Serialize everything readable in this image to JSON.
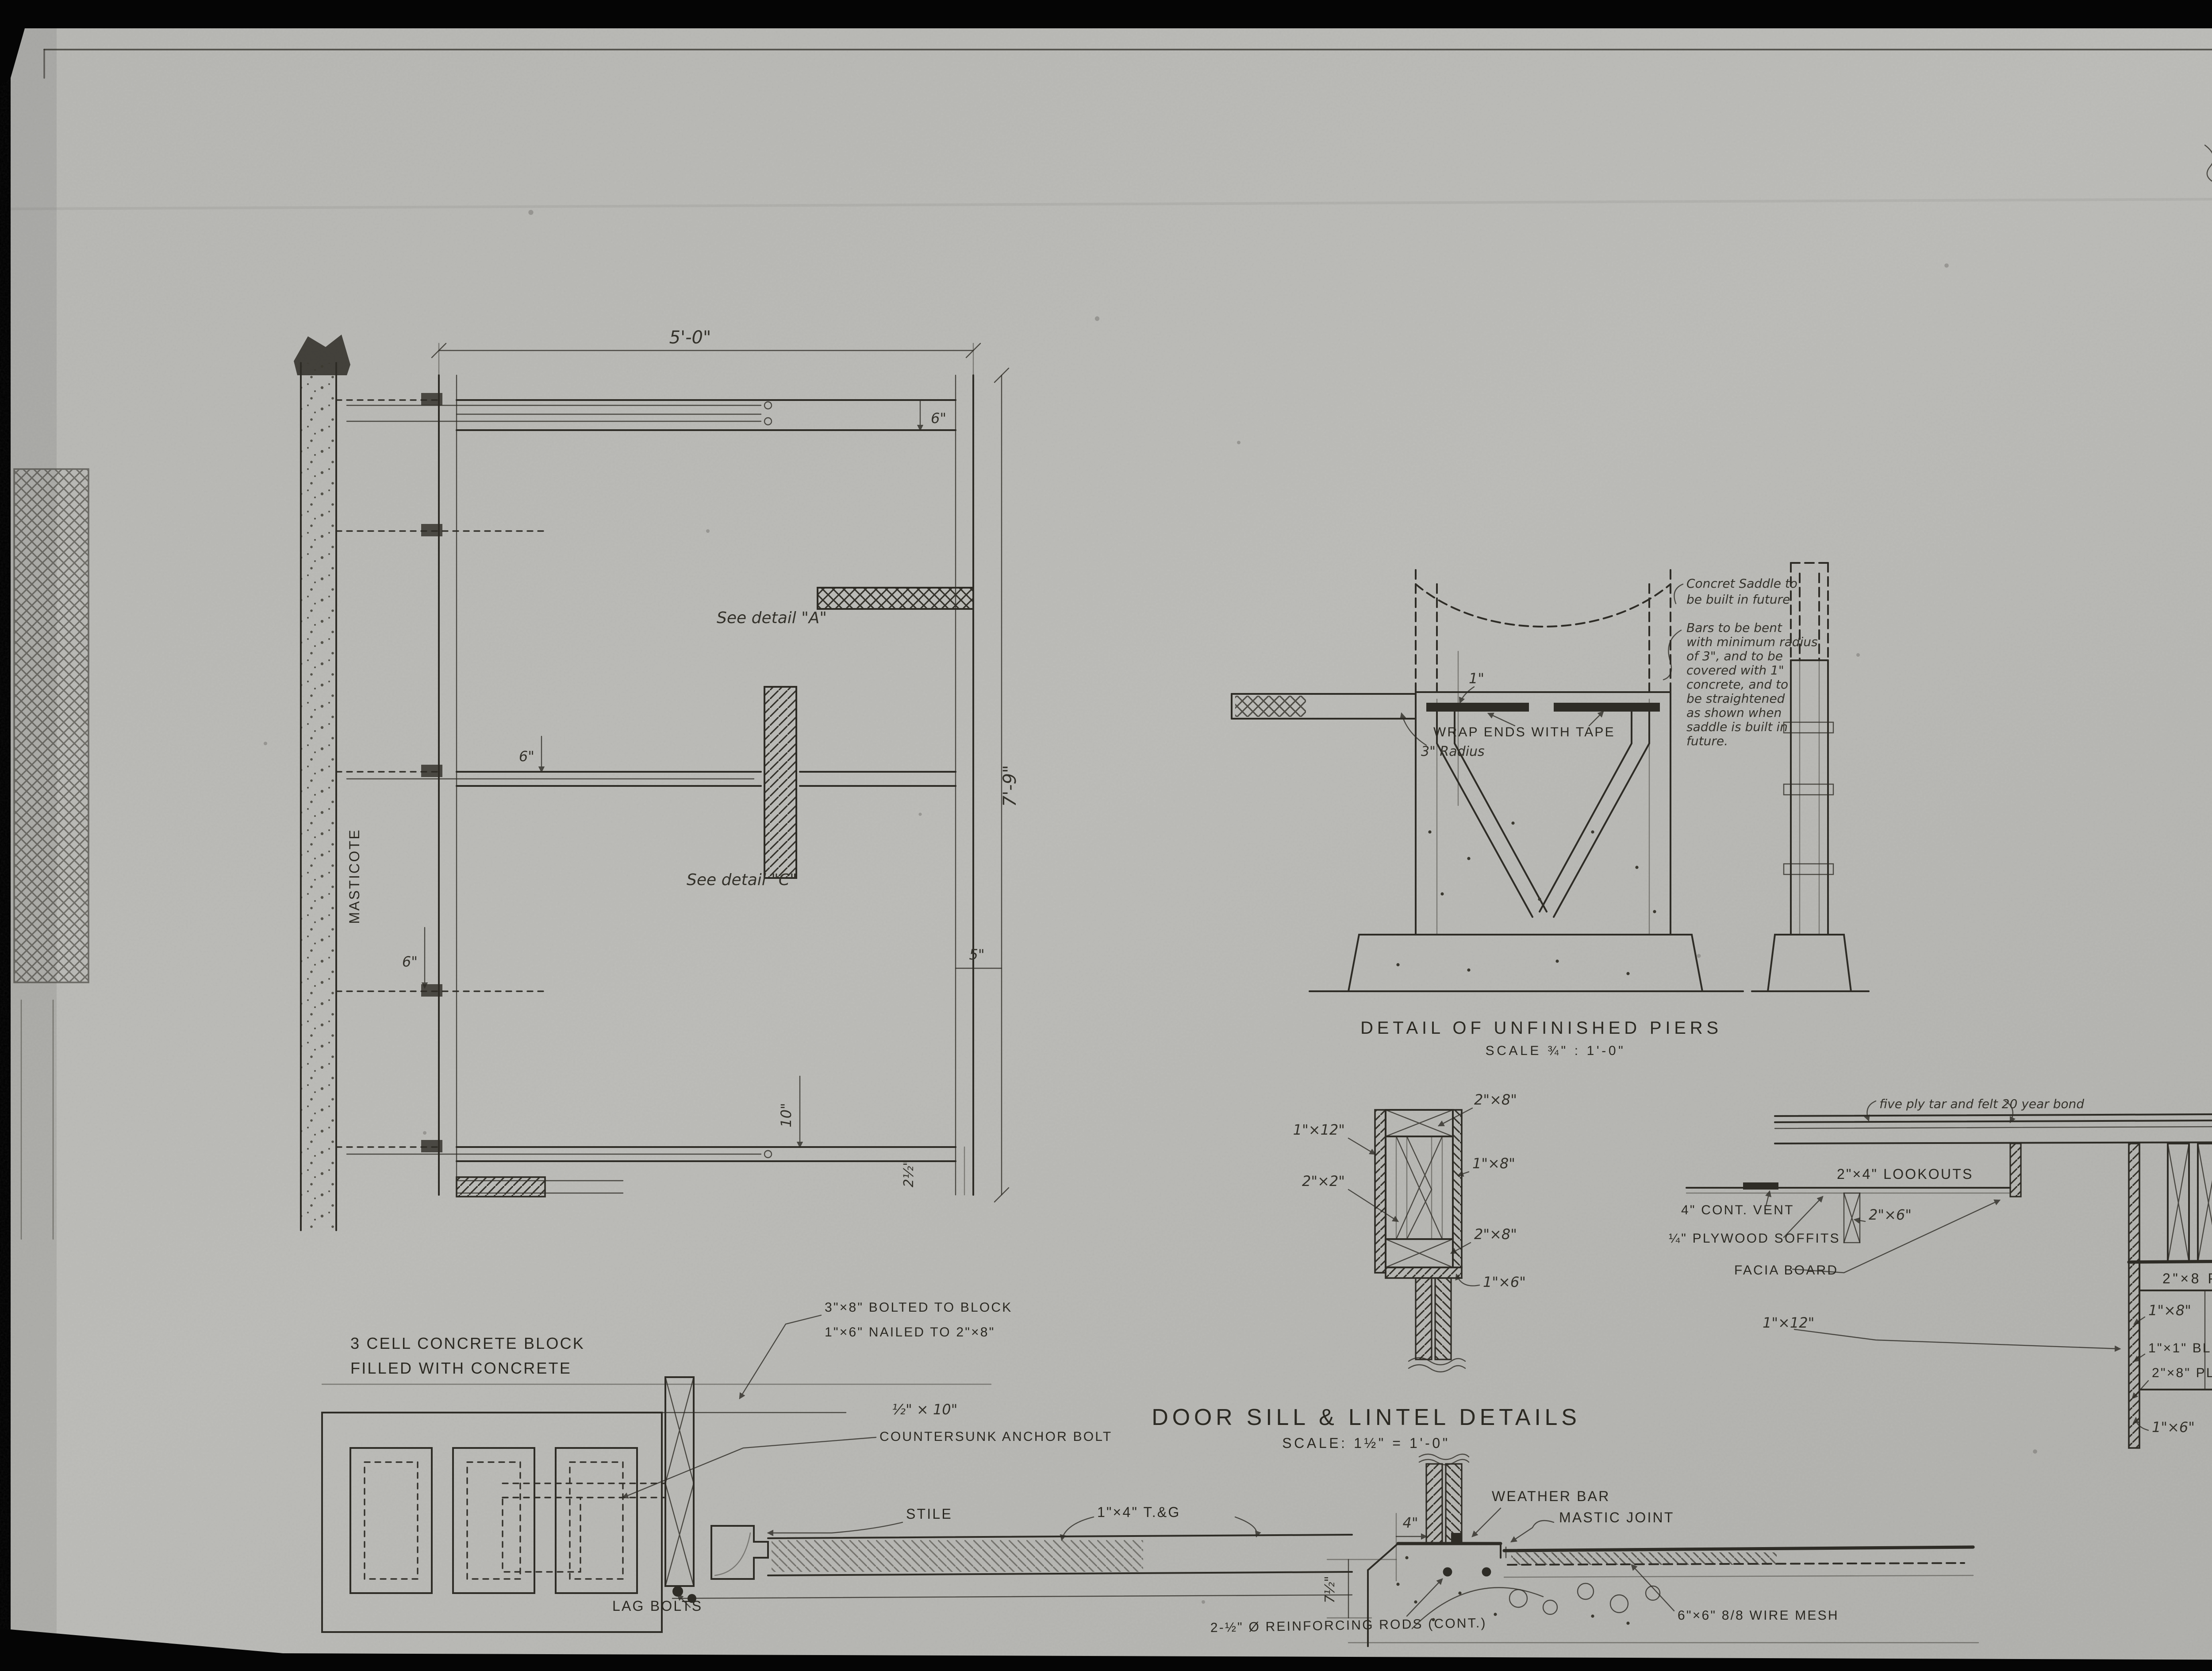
{
  "sheet": {
    "number_label": "2 of / de"
  },
  "plan": {
    "dim_width": "5'-0\"",
    "dim_height": "7'-9\"",
    "see_detail_a": "See detail \"A\"",
    "see_detail_c": "See detail \"C\"",
    "masticote": "MASTICOTE",
    "dim_6_top": "6\"",
    "dim_6_mid": "6\"",
    "dim_6_low": "6\"",
    "dim_5": "5\"",
    "dim_10": "10\"",
    "dim_2half": "2½\""
  },
  "pier_detail": {
    "title": "DETAIL OF UNFINISHED PIERS",
    "scale": "SCALE ¾\" : 1'-0\"",
    "note_saddle_lines": [
      "Concret Saddle to",
      "be built in future"
    ],
    "note_bars_lines": [
      "Bars to be bent",
      "with minimum radius",
      "of 3\", and to be",
      "covered with 1\"",
      "concrete, and to",
      "be straightened",
      "as shown when",
      "saddle is built in",
      "future."
    ],
    "wrap_label": "WRAP ENDS WITH TAPE",
    "radius_label": "3\" Radius",
    "dim_1": "1\""
  },
  "block_detail": {
    "caption_lines": [
      "3 CELL CONCRETE BLOCK",
      "FILLED WITH CONCRETE"
    ],
    "bolted_lines": [
      "3\"×8\" BOLTED TO BLOCK",
      "1\"×6\" NAILED TO 2\"×8\""
    ],
    "anchor_lines": [
      "½\" × 10\"",
      "COUNTERSUNK ANCHOR BOLT"
    ],
    "stile": "STILE",
    "tongue_groove": "1\"×4\" T.&G",
    "lag_bolts": "LAG BOLTS"
  },
  "sill_detail": {
    "title": "DOOR SILL & LINTEL DETAILS",
    "scale": "SCALE: 1½\" = 1'-0\"",
    "weather_bar": "WEATHER BAR",
    "mastic_joint": "MASTIC JOINT",
    "dim_4": "4\"",
    "dim_7half": "7½\"",
    "rods": "2-½\" Ø REINFORCING RODS (CONT.)",
    "wire_mesh": "6\"×6\" 8/8 WIRE MESH"
  },
  "lintel_detail": {
    "l_2x8_top": "2\"×8\"",
    "l_1x12": "1\"×12\"",
    "l_2x2": "2\"×2\"",
    "l_1x8": "1\"×8\"",
    "l_2x8_bottom": "2\"×8\"",
    "l_1x6": "1\"×6\""
  },
  "eave_detail": {
    "felt_note": "five ply tar and felt 20 year bond",
    "lookouts": "2\"×4\" LOOKOUTS",
    "vent": "4\" CONT. VENT",
    "soffits": "¼\" PLYWOOD SOFFITS",
    "facia": "FACIA BOARD",
    "s_2x6": "2\"×6\"",
    "s_1x12": "1\"×12\"",
    "plate_top": "2\"×8 PLATE",
    "s_1x8": "1\"×8\"",
    "blocking": "1\"×1\" BLOCKING",
    "plate_bottom": "2\"×8\" PLATE",
    "conc_lines": [
      "CONC",
      "BLOCK"
    ],
    "s_1x6": "1\"×6\""
  }
}
